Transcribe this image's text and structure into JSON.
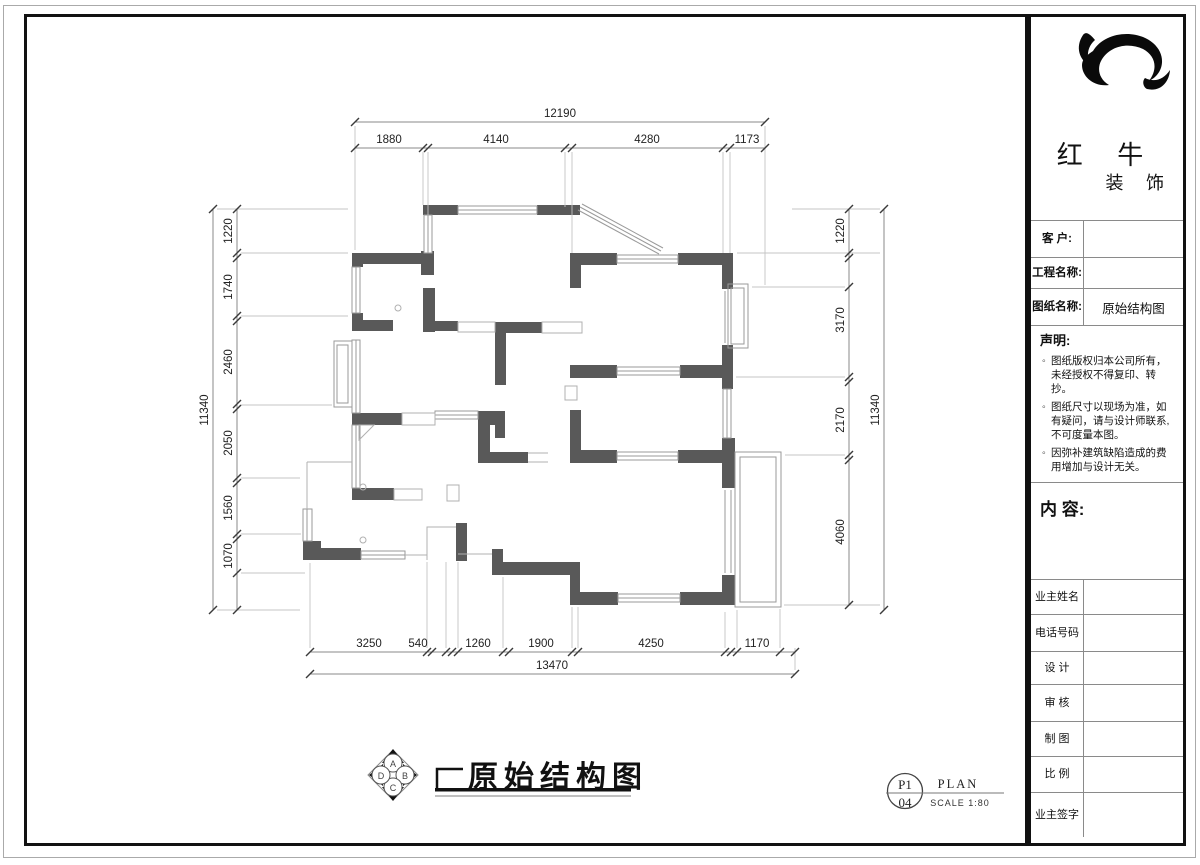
{
  "drawing": {
    "title": "原始结构图",
    "compass_letters": [
      "A",
      "B",
      "C",
      "D"
    ],
    "sheet_ref": {
      "code": "P1",
      "number": "04",
      "type": "PLAN",
      "scale": "SCALE 1:80"
    },
    "dimensions": {
      "top_total": "12190",
      "top_segments": [
        "1880",
        "4140",
        "4280",
        "1173"
      ],
      "left_total": "11340",
      "left_segments": [
        "1220",
        "1740",
        "2460",
        "2050",
        "1560",
        "1070"
      ],
      "right_total": "11340",
      "right_segments": [
        "1220",
        "3170",
        "2170",
        "4060"
      ],
      "bottom_total": "13470",
      "bottom_segments": [
        "3250",
        "540",
        "1260",
        "1900",
        "4250",
        "1170"
      ]
    }
  },
  "panel": {
    "brand": {
      "name": "红 牛",
      "suffix": "装 饰"
    },
    "info_fields": [
      {
        "label": "客  户:",
        "value": ""
      },
      {
        "label": "工程名称:",
        "value": ""
      },
      {
        "label": "图纸名称:",
        "value": "原始结构图"
      }
    ],
    "statement": {
      "heading": "声明:",
      "items": [
        "图纸版权归本公司所有，未经授权不得复印、转抄。",
        "图纸尺寸以现场为准，如有疑问，请与设计师联系,不可度量本图。",
        "因弥补建筑缺陷造成的费用增加与设计无关。"
      ]
    },
    "content_heading": "内 容:",
    "sign_rows": [
      {
        "label": "业主姓名"
      },
      {
        "label": "电话号码"
      },
      {
        "label": "设 计"
      },
      {
        "label": "审 核"
      },
      {
        "label": "制 图"
      },
      {
        "label": "比 例"
      },
      {
        "label": "业主签字"
      }
    ]
  },
  "colors": {
    "wall": "#595959",
    "window_line": "#9a9a9a",
    "frame": "#111111",
    "dim_line": "#8a8a8a"
  }
}
